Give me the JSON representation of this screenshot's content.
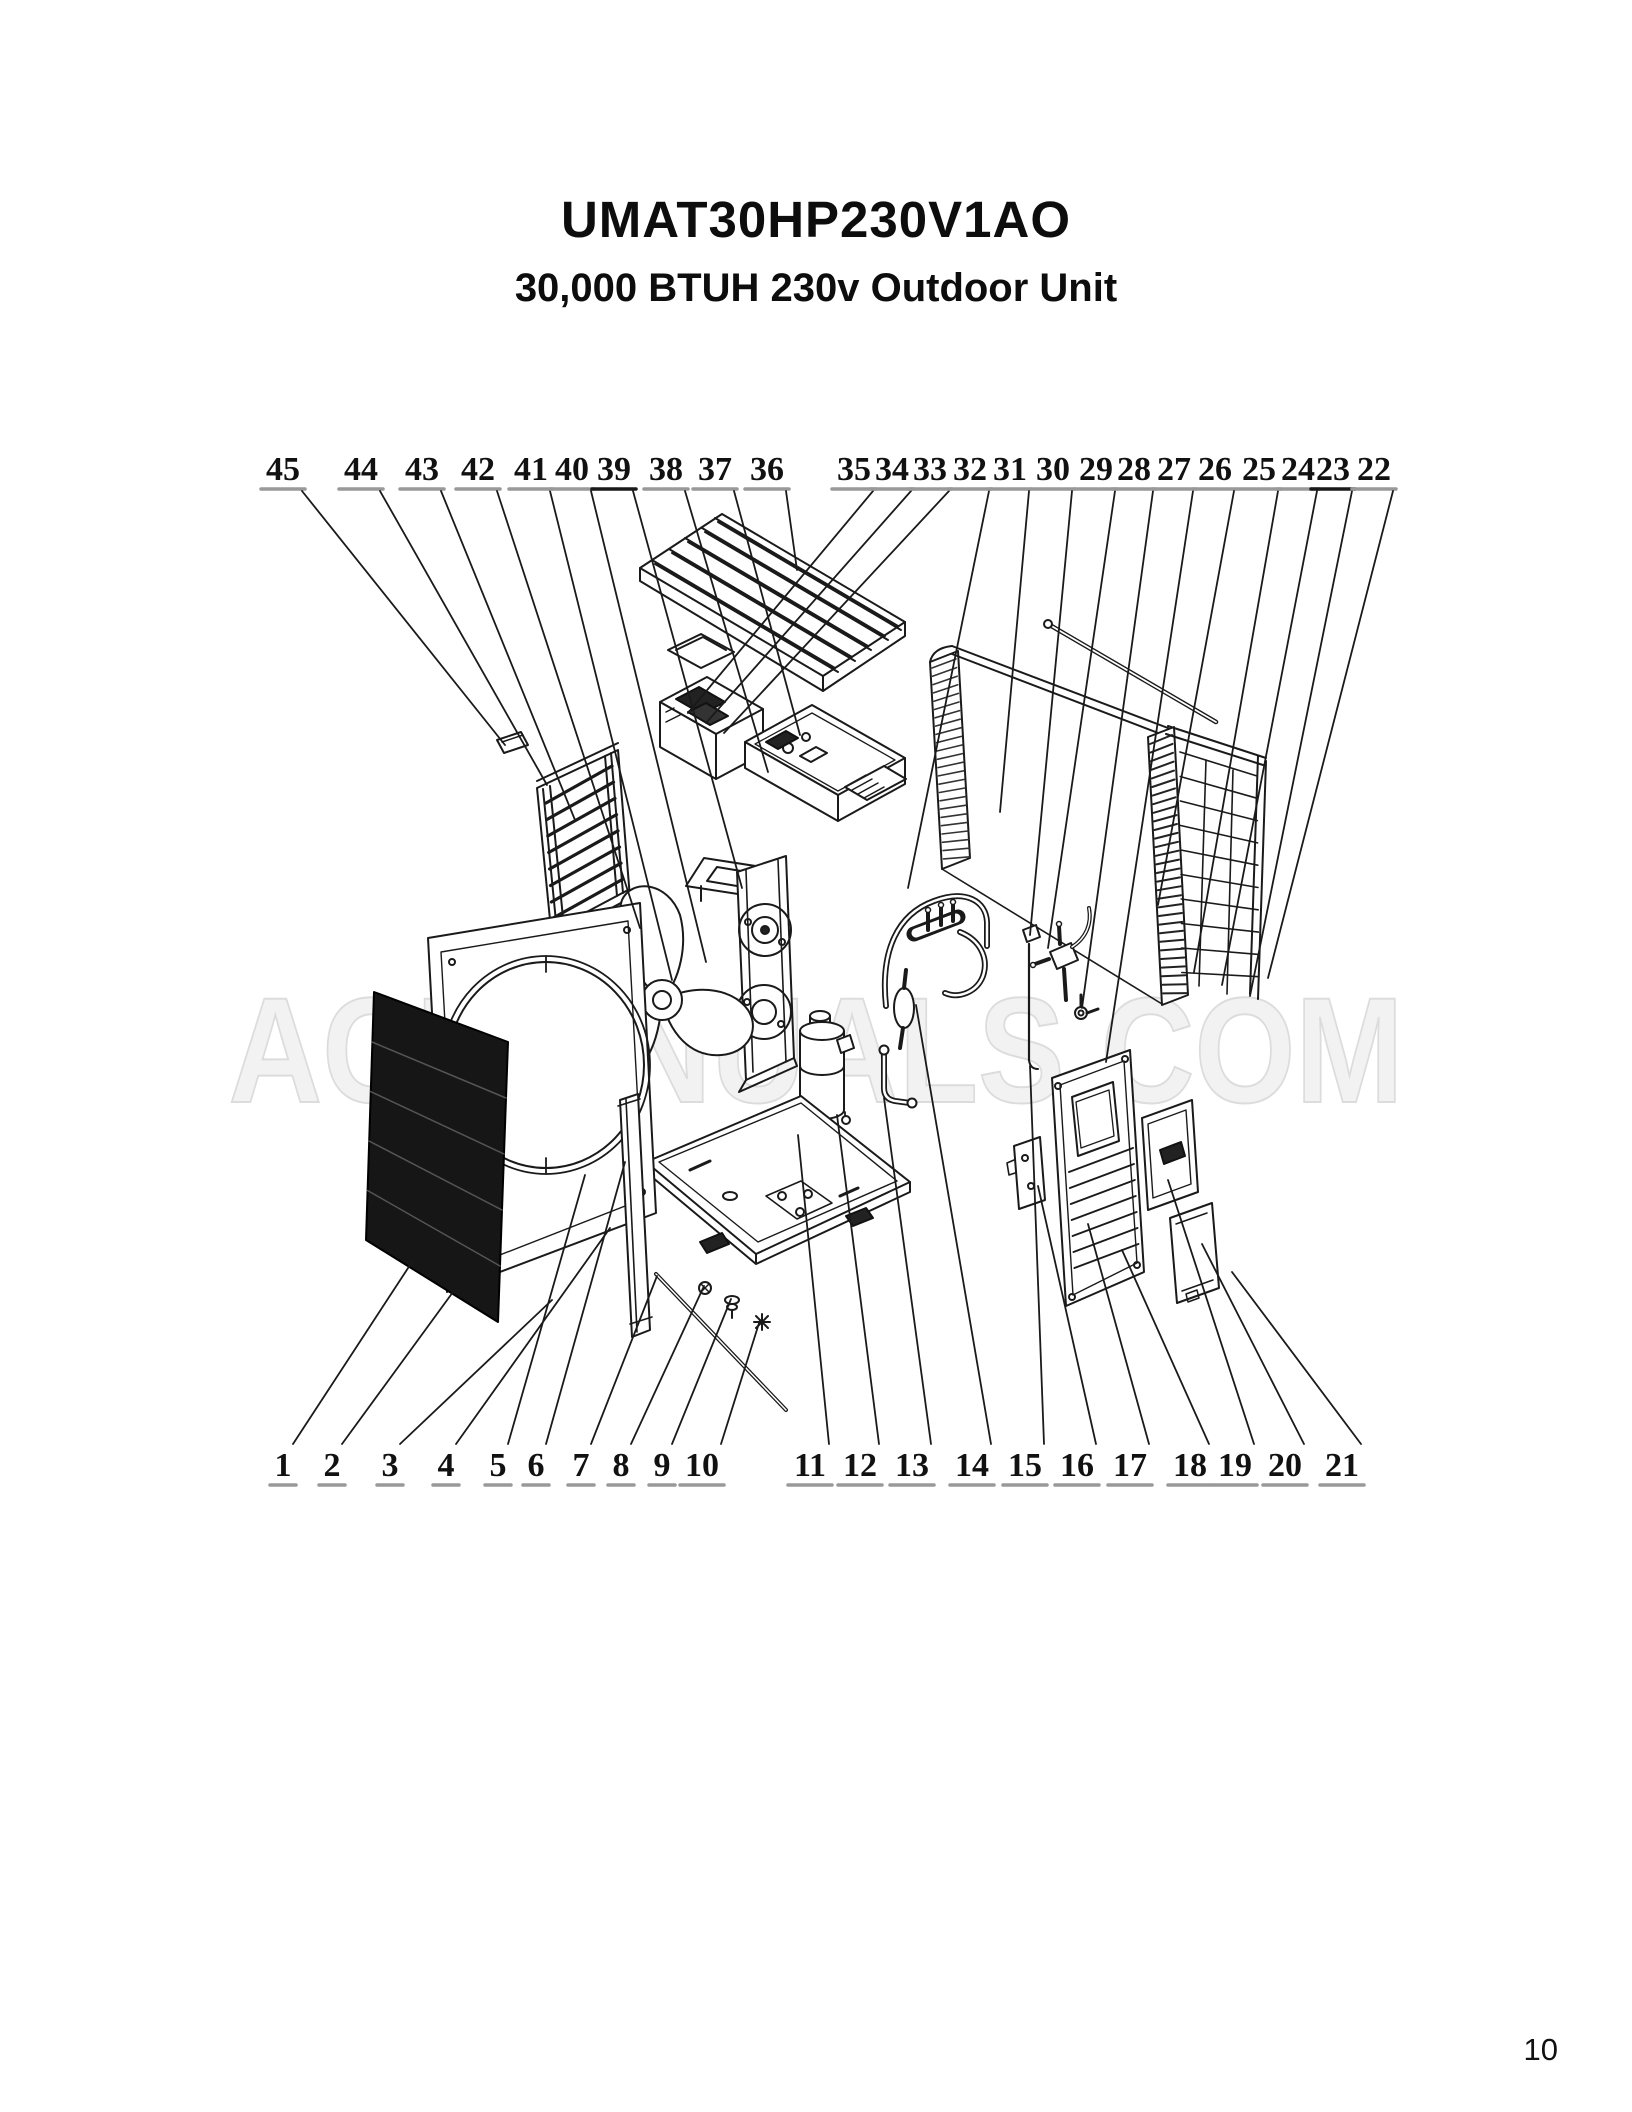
{
  "page": {
    "title": "UMAT30HP230V1AO",
    "subtitle": "30,000 BTUH 230v Outdoor Unit",
    "watermark": "ACMANUALS.COM",
    "page_number": "10"
  },
  "diagram": {
    "type": "exploded-parts-diagram",
    "unit_model": "UMAT30HP230V1AO",
    "colors": {
      "line": "#1a1a1a",
      "underline": "#999999",
      "underline_dark": "#1a1a1a",
      "watermark_fill": "#f2f2f2",
      "watermark_stroke": "#dcdcdc",
      "grille_fill": "#161616"
    },
    "callouts_top": [
      {
        "label": "45",
        "x": 283,
        "ex": 505,
        "ey": 745
      },
      {
        "label": "44",
        "x": 361,
        "ex": 547,
        "ey": 785
      },
      {
        "label": "43",
        "x": 422,
        "ex": 575,
        "ey": 820
      },
      {
        "label": "42",
        "x": 478,
        "ex": 640,
        "ey": 928
      },
      {
        "label": "41",
        "x": 531,
        "ex": 672,
        "ey": 980
      },
      {
        "label": "40",
        "x": 572,
        "ex": 706,
        "ey": 962
      },
      {
        "label": "39",
        "x": 614,
        "dark_underline": true,
        "ex": 742,
        "ey": 888
      },
      {
        "label": "38",
        "x": 666,
        "ex": 768,
        "ey": 772
      },
      {
        "label": "37",
        "x": 715,
        "ex": 800,
        "ey": 735
      },
      {
        "label": "36",
        "x": 767,
        "ex": 797,
        "ey": 570
      },
      {
        "label": "35",
        "x": 854,
        "ex": 688,
        "ey": 713
      },
      {
        "label": "34",
        "x": 892,
        "ex": 706,
        "ey": 723
      },
      {
        "label": "33",
        "x": 930,
        "ex": 724,
        "ey": 733
      },
      {
        "label": "32",
        "x": 970,
        "ex": 908,
        "ey": 888
      },
      {
        "label": "31",
        "x": 1010,
        "ex": 1000,
        "ey": 812
      },
      {
        "label": "30",
        "x": 1053,
        "ex": 1030,
        "ey": 935
      },
      {
        "label": "29",
        "x": 1096,
        "ex": 1048,
        "ey": 948
      },
      {
        "label": "28",
        "x": 1134,
        "ex": 1082,
        "ey": 1008
      },
      {
        "label": "27",
        "x": 1174,
        "ex": 1106,
        "ey": 1062
      },
      {
        "label": "26",
        "x": 1215,
        "ex": 1158,
        "ey": 905
      },
      {
        "label": "25",
        "x": 1259,
        "ex": 1194,
        "ey": 972
      },
      {
        "label": "24",
        "x": 1298,
        "ex": 1222,
        "ey": 985
      },
      {
        "label": "23",
        "x": 1333,
        "dark_underline": true,
        "ex": 1250,
        "ey": 996
      },
      {
        "label": "22",
        "x": 1374,
        "ex": 1268,
        "ey": 978
      }
    ],
    "callouts_bottom": [
      {
        "label": "1",
        "x": 283,
        "ex": 412,
        "ey": 1262
      },
      {
        "label": "2",
        "x": 332,
        "ex": 453,
        "ey": 1292
      },
      {
        "label": "3",
        "x": 390,
        "ex": 552,
        "ey": 1300
      },
      {
        "label": "4",
        "x": 446,
        "ex": 610,
        "ey": 1228
      },
      {
        "label": "5",
        "x": 498,
        "ex": 585,
        "ey": 1175
      },
      {
        "label": "6",
        "x": 536,
        "ex": 625,
        "ey": 1162
      },
      {
        "label": "7",
        "x": 581,
        "ex": 657,
        "ey": 1276
      },
      {
        "label": "8",
        "x": 621,
        "ex": 704,
        "ey": 1286
      },
      {
        "label": "9",
        "x": 662,
        "ex": 731,
        "ey": 1299
      },
      {
        "label": "10",
        "x": 702,
        "ex": 760,
        "ey": 1320
      },
      {
        "label": "11",
        "x": 810,
        "ex": 798,
        "ey": 1135
      },
      {
        "label": "12",
        "x": 860,
        "ex": 837,
        "ey": 1115
      },
      {
        "label": "13",
        "x": 912,
        "ex": 884,
        "ey": 1098
      },
      {
        "label": "14",
        "x": 972,
        "ex": 916,
        "ey": 1005
      },
      {
        "label": "15",
        "x": 1025,
        "ex": 1030,
        "ey": 1066
      },
      {
        "label": "16",
        "x": 1077,
        "ex": 1038,
        "ey": 1186
      },
      {
        "label": "17",
        "x": 1130,
        "ex": 1088,
        "ey": 1224
      },
      {
        "label": "18",
        "x": 1190,
        "ex": 1122,
        "ey": 1250
      },
      {
        "label": "19",
        "x": 1235,
        "ex": 1168,
        "ey": 1180
      },
      {
        "label": "20",
        "x": 1285,
        "ex": 1202,
        "ey": 1244
      },
      {
        "label": "21",
        "x": 1342,
        "ex": 1232,
        "ey": 1272
      }
    ]
  }
}
